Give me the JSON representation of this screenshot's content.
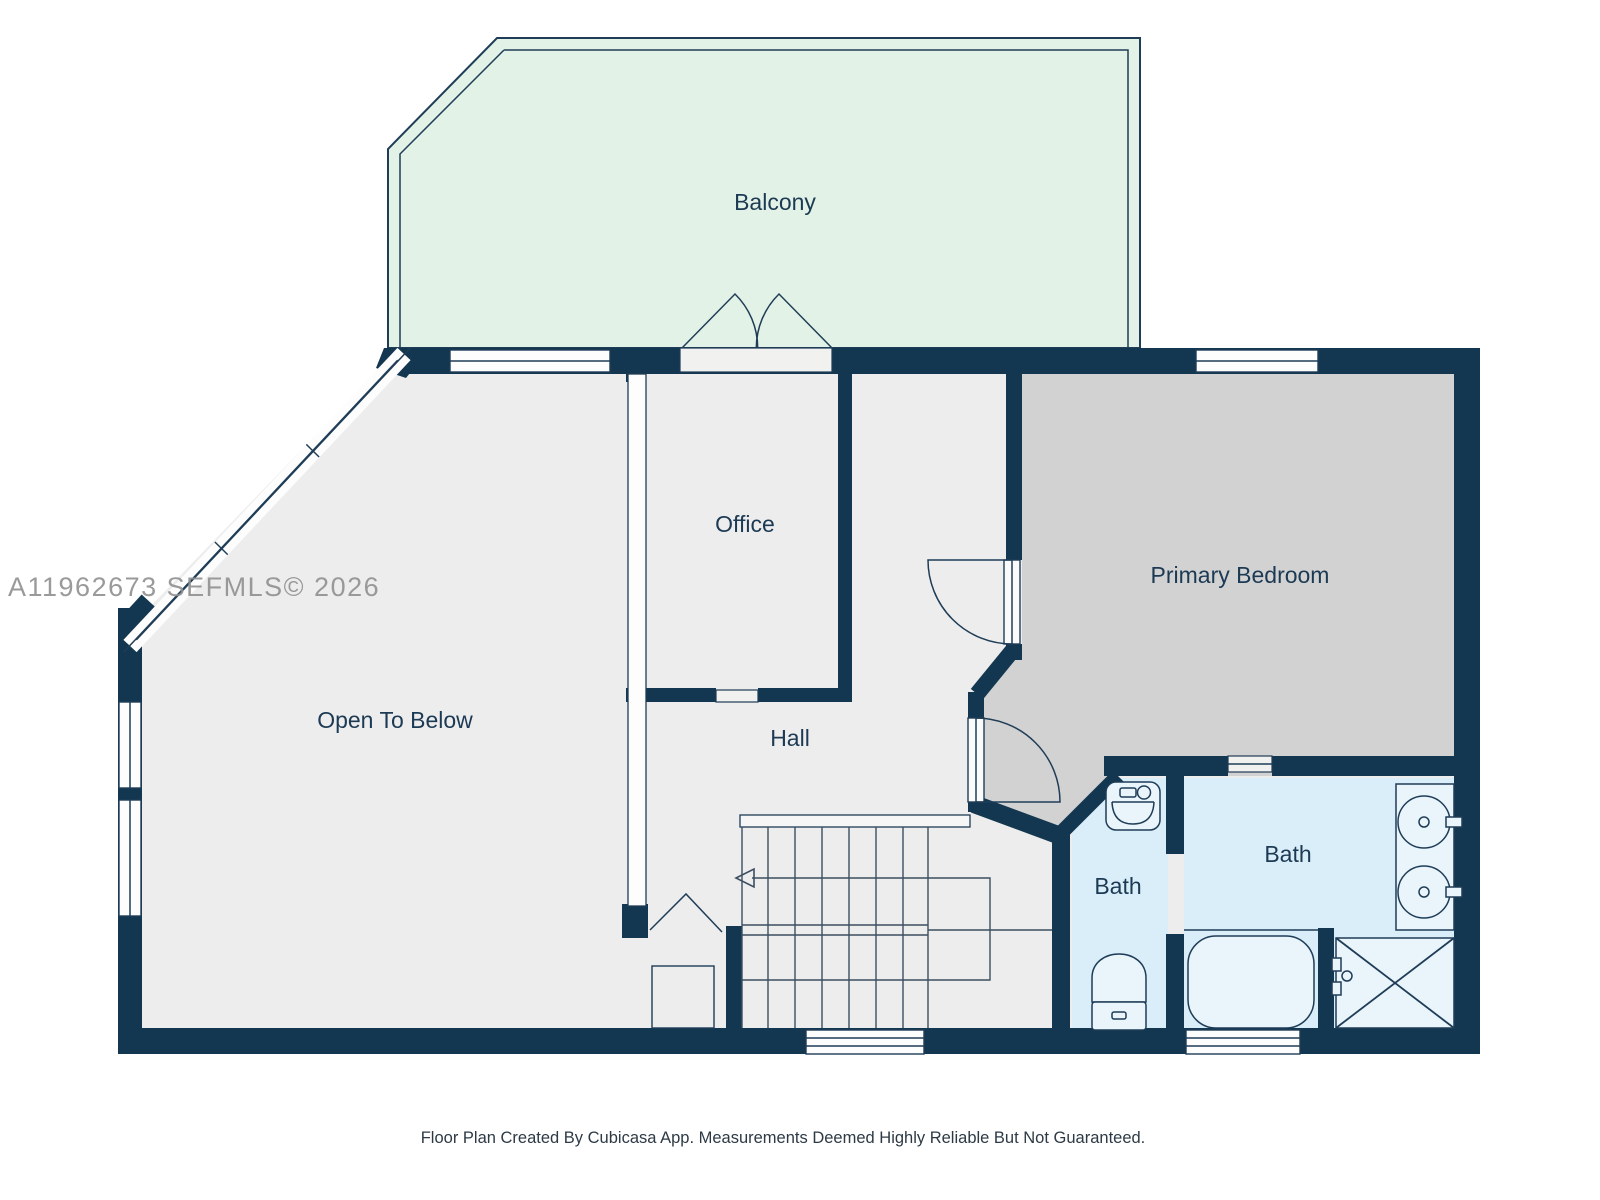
{
  "watermark": "A11962673 SEFMLS© 2026",
  "footer": "Floor Plan Created By Cubicasa App. Measurements Deemed Highly Reliable But Not Guaranteed.",
  "rooms": {
    "balcony": {
      "label": "Balcony"
    },
    "office": {
      "label": "Office"
    },
    "open_to_below": {
      "label": "Open To Below"
    },
    "hall": {
      "label": "Hall"
    },
    "primary_bedroom": {
      "label": "Primary Bedroom"
    },
    "bath_small": {
      "label": "Bath"
    },
    "bath_large": {
      "label": "Bath"
    }
  },
  "icons": [
    "sink-icon",
    "toilet-icon",
    "bathtub-icon",
    "shower-icon",
    "vanity-sinks-icon",
    "stairs-direction-arrow-icon"
  ],
  "colors": {
    "wall": "#133750",
    "room_fill": "#ededed",
    "bedroom_fill": "#d2d2d2",
    "bath_fill": "#daeef9",
    "balcony_fill": "#e2f2e6",
    "fixture_fill": "#e9f4fb",
    "label_text": "#1c3a54",
    "watermark": "#909090",
    "footer_text": "#2d3a46"
  }
}
